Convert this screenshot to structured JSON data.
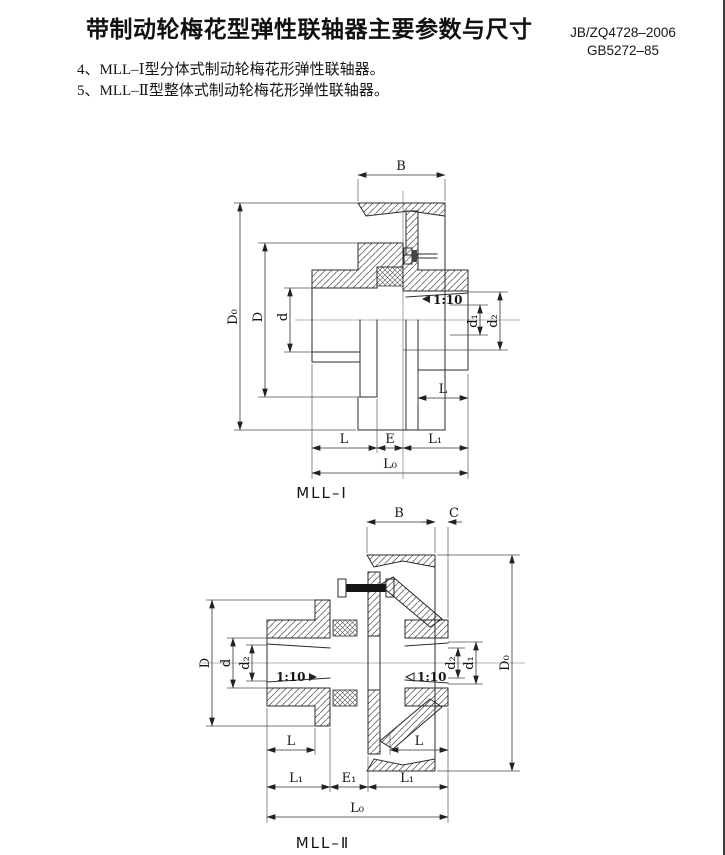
{
  "header": {
    "title": "带制动轮梅花型弹性联轴器主要参数与尺寸",
    "standard1": "JB/ZQ4728–2006",
    "standard2": "GB5272–85"
  },
  "notes": {
    "item4": "4、MLL–Ⅰ型分体式制动轮梅花形弹性联轴器。",
    "item5": "5、MLL–Ⅱ型整体式制动轮梅花形弹性联轴器。"
  },
  "figure1": {
    "caption": "MLL–Ⅰ",
    "labels": {
      "B": "B",
      "D0": "D₀",
      "D": "D",
      "d": "d",
      "d1": "d₁",
      "d2": "d₂",
      "L": "L",
      "E": "E",
      "L1": "L₁",
      "L0": "L₀",
      "taper": "1:10"
    }
  },
  "figure2": {
    "caption": "MLL–Ⅱ",
    "labels": {
      "B": "B",
      "C": "C",
      "D0": "D₀",
      "D": "D",
      "d": "d",
      "d1": "d₁",
      "d2": "d₂",
      "L": "L",
      "L1": "L₁",
      "E1": "E₁",
      "L0": "L₀",
      "taper": "1:10"
    }
  },
  "colors": {
    "line": "#2b2b2b",
    "background": "#ffffff"
  }
}
